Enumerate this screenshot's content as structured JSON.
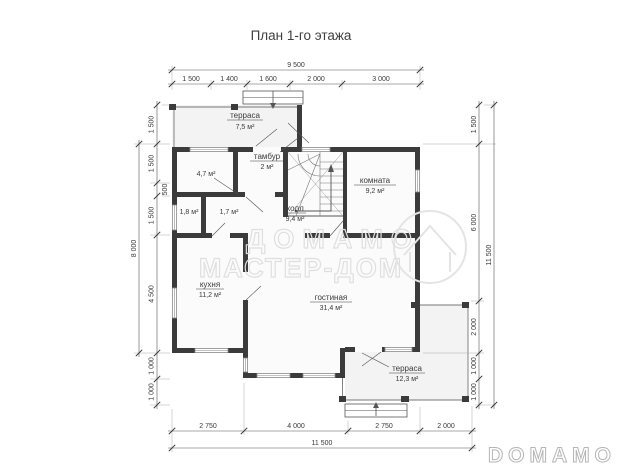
{
  "title": "План 1-го этажа",
  "watermark": {
    "line1": "ДОМАМО",
    "line2": "МАСТЕР-ДОМ"
  },
  "brand_logo": "DOMAMO",
  "rooms": {
    "terrace_top": {
      "name": "терраса",
      "area": "7,5 м²"
    },
    "tambour": {
      "name": "тамбур",
      "area": "2 м²"
    },
    "room_47": {
      "area": "4,7 м²"
    },
    "room_18": {
      "area": "1,8 м²"
    },
    "room_17": {
      "area": "1,7 м²"
    },
    "hall": {
      "name": "холл",
      "area": "9,4 м²"
    },
    "bedroom": {
      "name": "комната",
      "area": "9,2 м²"
    },
    "kitchen": {
      "name": "кухня",
      "area": "11,2 м²"
    },
    "living": {
      "name": "гостиная",
      "area": "31,4 м²"
    },
    "terrace_bottom": {
      "name": "терраса",
      "area": "12,3 м²"
    }
  },
  "dimensions": {
    "top_total": "9 500",
    "top_segments": [
      "1 500",
      "1 400",
      "1 600",
      "2 000",
      "3 000"
    ],
    "bottom_segments": [
      "2 750",
      "4 000",
      "2 750",
      "2 000"
    ],
    "bottom_total": "11 500",
    "left_outer": "8 000",
    "left_segments": [
      "1 500",
      "1 500",
      "500",
      "1 500",
      "4 500",
      "1 000",
      "1 000"
    ],
    "right_segments": [
      "1 500",
      "6 000",
      "2 000",
      "1 000",
      "1 000"
    ],
    "right_total": "11 500"
  },
  "colors": {
    "wall": "#3b3b3b",
    "dim_line": "#555555",
    "watermark": "#dfdfdf",
    "brand_outline": "#b5b5b5"
  }
}
